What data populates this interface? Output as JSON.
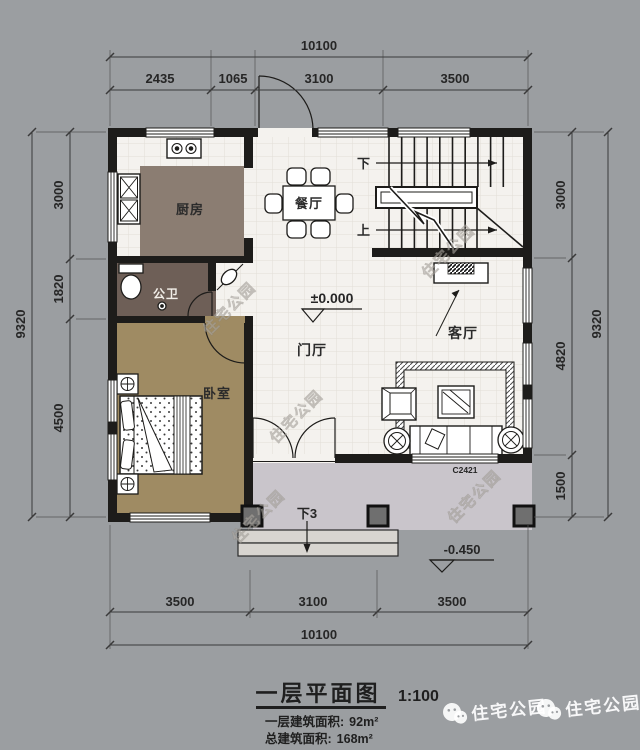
{
  "plan": {
    "rooms": {
      "kitchen": "厨房",
      "dining": "餐厅",
      "bath": "公卫",
      "bedroom": "卧室",
      "foyer": "门厅",
      "living": "客厅"
    },
    "stair": {
      "down": "下",
      "up": "上"
    },
    "levels": {
      "ground": "±0.000",
      "porch": "-0.450"
    },
    "porch_steps": "下3",
    "window_code": "C2421"
  },
  "dims": {
    "top": {
      "total": "10100",
      "segments": [
        "2435",
        "1065",
        "3100",
        "3500"
      ]
    },
    "bottom": {
      "total": "10100",
      "segments": [
        "3500",
        "3100",
        "3500"
      ]
    },
    "left": {
      "total": "9320",
      "segments": [
        "3000",
        "1820",
        "4500"
      ]
    },
    "right": {
      "total": "9320",
      "segments": [
        "3000",
        "4820",
        "1500"
      ]
    }
  },
  "title_block": {
    "title": "一层平面图",
    "scale": "1:100",
    "area1_label": "一层建筑面积:",
    "area1_value": "92m²",
    "area2_label": "总建筑面积:",
    "area2_value": "168m²"
  },
  "watermark": {
    "brand": "住宅公园"
  },
  "colors": {
    "background": "#9b9ea1",
    "floor_tile": "#f4f2ee",
    "kitchen_floor": "#8b7d72",
    "bath_floor": "#6e5f57",
    "bedroom_floor": "#9f8b63",
    "porch_floor": "#c9c5cb",
    "wall": "#1d1c1a"
  }
}
